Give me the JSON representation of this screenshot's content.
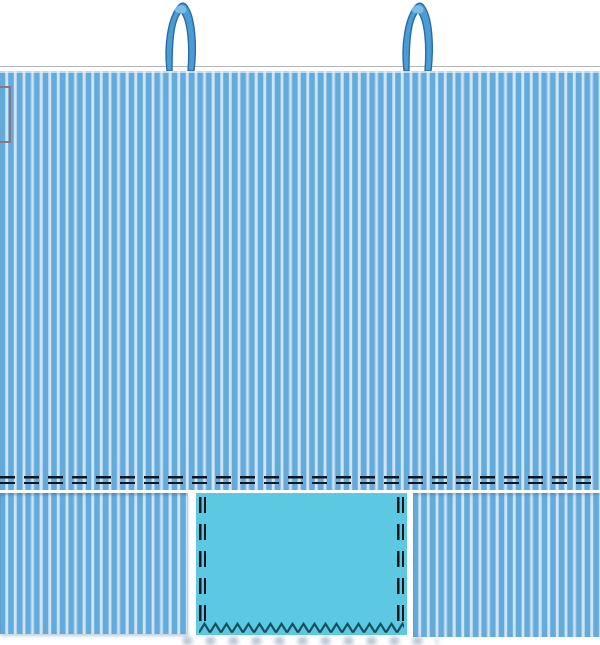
{
  "scene": {
    "kind": "sewing-pattern-diagram",
    "subject": "striped tote bag with handles, stitch lines and pocket panel",
    "visible_text": ""
  },
  "colors": {
    "background": "#ffffff",
    "stripe_light": "#cde5f5",
    "stripe_medium": "#64abdc",
    "stripe_accent": "#8fc1e9",
    "handle_fill": "#4a9cd3",
    "handle_outline": "#2a6ba6",
    "handle_highlight": "#82c4ec",
    "pocket_fill": "#5cc8e2",
    "stitch_dash": "#10161b",
    "zigzag": "#14505f",
    "top_edge_line": "#b5b5b5",
    "marker_border": "#8a767c"
  },
  "elements": {
    "handles": [
      "left-handle",
      "right-handle"
    ],
    "body": "striped-bag-body",
    "stitch_lines": [
      "horizontal-double-dashed",
      "pocket-left-dashed",
      "pocket-right-dashed"
    ],
    "pocket_edge": "zigzag-overlock",
    "marker": "partial-rectangle-at-left-edge",
    "bottom_row": [
      "striped-panel-left",
      "cyan-pocket-panel",
      "striped-panel-right"
    ]
  }
}
